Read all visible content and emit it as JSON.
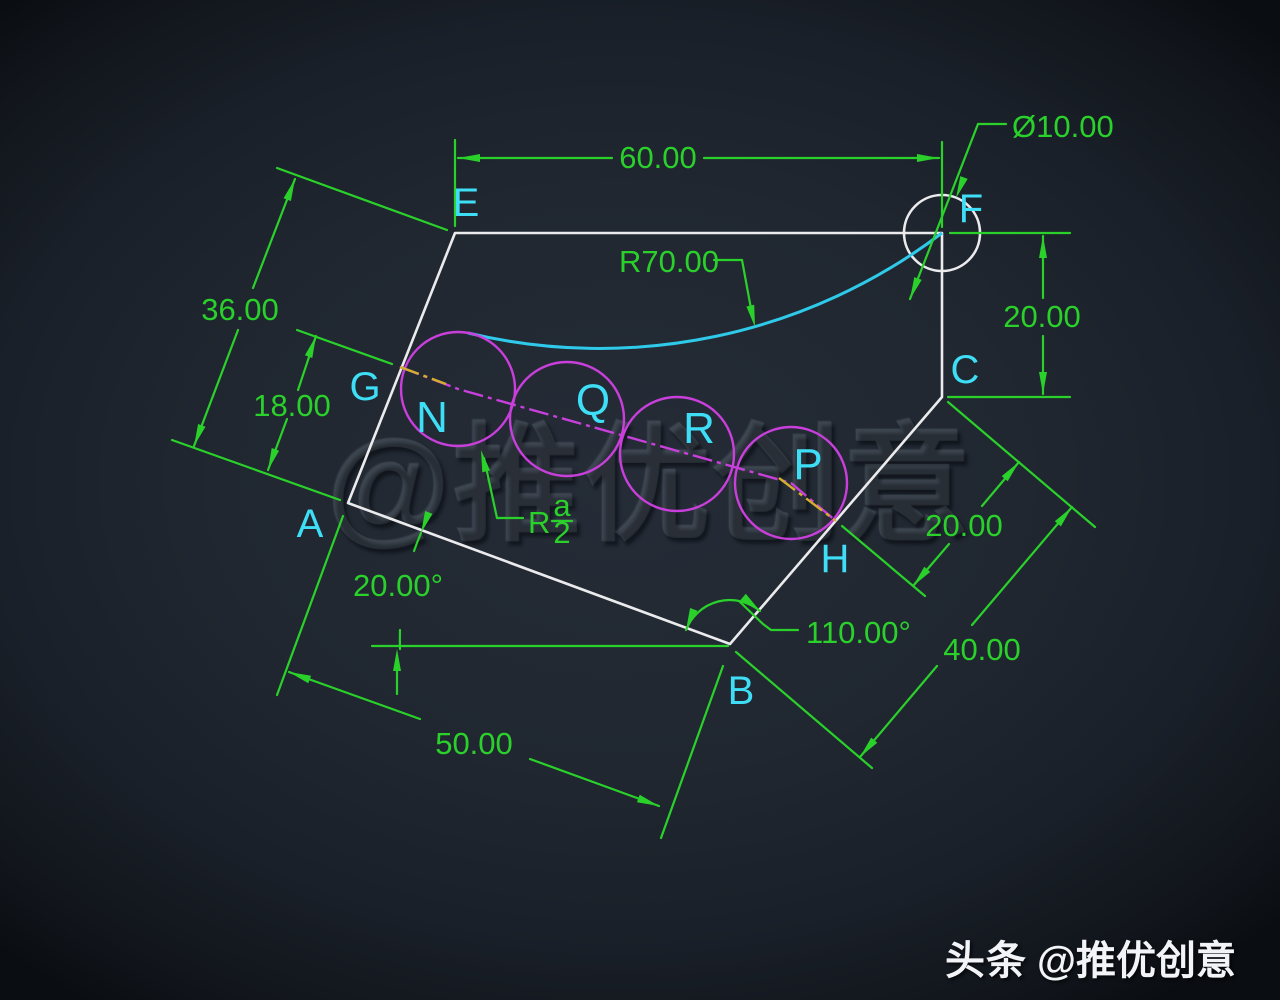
{
  "drawing": {
    "type": "cad-geometry-exercise",
    "colors": {
      "background": "#202730",
      "dimension_green": "#2bd12b",
      "label_cyan": "#3edff6",
      "construction_magenta": "#c93fdb",
      "outline_white": "#ebebed",
      "arc_cyan": "#2fc9ea",
      "centerline_yellow": "#d4af2e"
    },
    "vertices": {
      "A": "A",
      "B": "B",
      "C": "C",
      "E": "E",
      "F": "F",
      "G": "G",
      "H": "H"
    },
    "circles": {
      "N": "N",
      "Q": "Q",
      "R": "R",
      "P": "P"
    },
    "dims": {
      "top_width": "60.00",
      "hole_diameter": "Ø10.00",
      "arc_radius": "R70.00",
      "edge_ae": "36.00",
      "seg_ag": "18.00",
      "fc_height": "20.00",
      "hc_length": "20.00",
      "bc_length": "40.00",
      "ab_length": "50.00",
      "angle_a": "20.00°",
      "angle_b": "110.00°",
      "radius_prefix": "R",
      "radius_numerator": "a",
      "radius_denominator": "2"
    },
    "watermarks": {
      "center": "@推优创意",
      "badge": "头条",
      "handle": "@推优创意"
    }
  }
}
